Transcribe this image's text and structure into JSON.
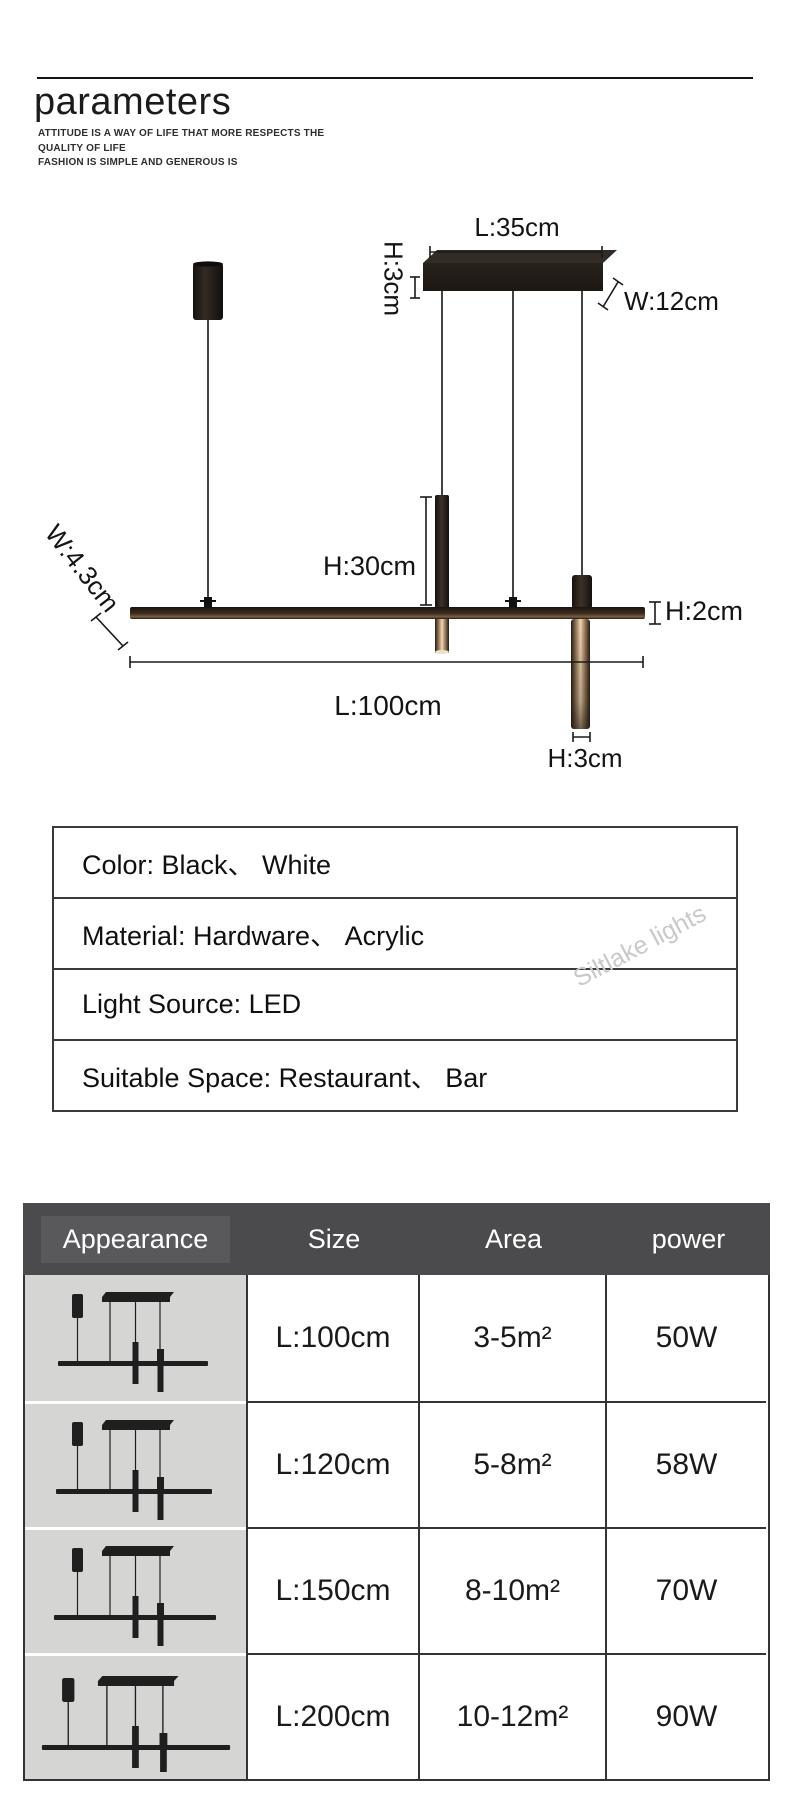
{
  "header": {
    "title": "parameters",
    "subtitle_line1": "ATTITUDE IS A WAY OF LIFE THAT MORE RESPECTS THE QUALITY OF LIFE",
    "subtitle_line2": "FASHION IS SIMPLE AND GENEROUS IS"
  },
  "diagram": {
    "labels": {
      "plate_length": "L:35cm",
      "plate_height": "H:3cm",
      "plate_width": "W:12cm",
      "tube_height": "H:30cm",
      "bar_height": "H:2cm",
      "bar_width": "W:4.3cm",
      "bar_length": "L:100cm",
      "bottom_tube_height": "H:3cm"
    }
  },
  "spec_table": {
    "rows": [
      {
        "text": "Color: Black、 White"
      },
      {
        "text": "Material: Hardware、 Acrylic"
      },
      {
        "text": "Light Source: LED"
      },
      {
        "text": "Suitable Space: Restaurant、 Bar"
      }
    ]
  },
  "watermark": "Siltlake lights",
  "size_table": {
    "headers": {
      "appearance": "Appearance",
      "size": "Size",
      "area": "Area",
      "power": "power"
    },
    "rows": [
      {
        "size": "L:100cm",
        "area": "3-5m²",
        "power": "50W"
      },
      {
        "size": "L:120cm",
        "area": "5-8m²",
        "power": "58W"
      },
      {
        "size": "L:150cm",
        "area": "8-10m²",
        "power": "70W"
      },
      {
        "size": "L:200cm",
        "area": "10-12m²",
        "power": "90W"
      }
    ]
  },
  "colors": {
    "table_header_bg": "#4b4b4d",
    "appearance_cell_bg": "#d5d5d4",
    "lamp_body": "#1f1813",
    "glow_highlight": "#ecd9bd",
    "watermark": "#c9c9c9",
    "text": "#1a1a1a"
  }
}
